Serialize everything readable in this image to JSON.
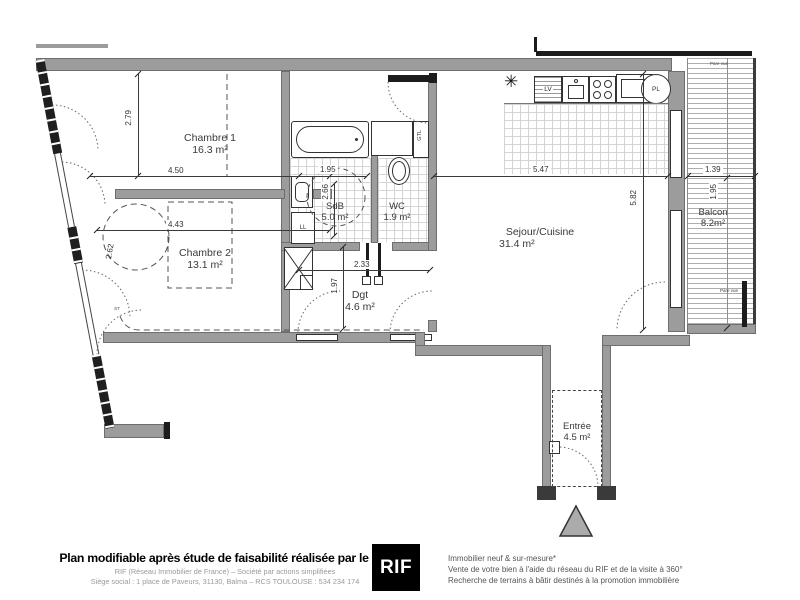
{
  "plan": {
    "rooms": [
      {
        "id": "chambre1",
        "name": "Chambre 1",
        "area": "16.3 m²"
      },
      {
        "id": "chambre2",
        "name": "Chambre 2",
        "area": "13.1 m²"
      },
      {
        "id": "sdb",
        "name": "SdB",
        "area": "5.0 m²"
      },
      {
        "id": "wc",
        "name": "WC",
        "area": "1.9 m²"
      },
      {
        "id": "dgt",
        "name": "Dgt",
        "area": "4.6 m²"
      },
      {
        "id": "sejour",
        "name": "Sejour/Cuisine",
        "area": "31.4 m²"
      },
      {
        "id": "balcon",
        "name": "Balcon",
        "area": "8.2m²"
      },
      {
        "id": "entree",
        "name": "Entrée",
        "area": "4.5 m²"
      }
    ],
    "dimensions": {
      "chambre1_width": "4.50",
      "chambre1_depth": "2.79",
      "chambre2_width": "4.43",
      "chambre2_wall": "2.62",
      "sdb_width": "1.95",
      "sdb_depth": "2.66",
      "dgt_width": "2.33",
      "dgt_depth": "1.97",
      "sejour_width": "5.47",
      "sejour_depth": "5.82",
      "balcon_width": "1.39",
      "balcon_depth": "1.95"
    },
    "labels": {
      "gtl": "GTL",
      "ll": "LL",
      "lv": "LV",
      "pl": "PL",
      "st": "ST",
      "pare_vue": "Pare vue"
    },
    "symbols": {
      "star": "✳"
    }
  },
  "footer": {
    "headline": "Plan modifiable après étude de faisabilité réalisée par le RIF",
    "legal_line1": "RIF (Réseau Immobilier de France) – Société par actions simplifiées",
    "legal_line2": "Siège social : 1 place de Paveurs, 31130, Balma – RCS TOULOUSE : 534 234 174",
    "logo_text": "RIF",
    "services": [
      "Immobilier neuf & sur-mesure*",
      "Vente de votre bien à l'aide du réseau du RIF et de la visite à 360°",
      "Recherche de terrains à bâtir destinés à la promotion immobilière"
    ]
  },
  "colors": {
    "wall_gray": "#9c9c9c",
    "line_dark": "#1c1c1c",
    "logo_bg": "#000000"
  }
}
